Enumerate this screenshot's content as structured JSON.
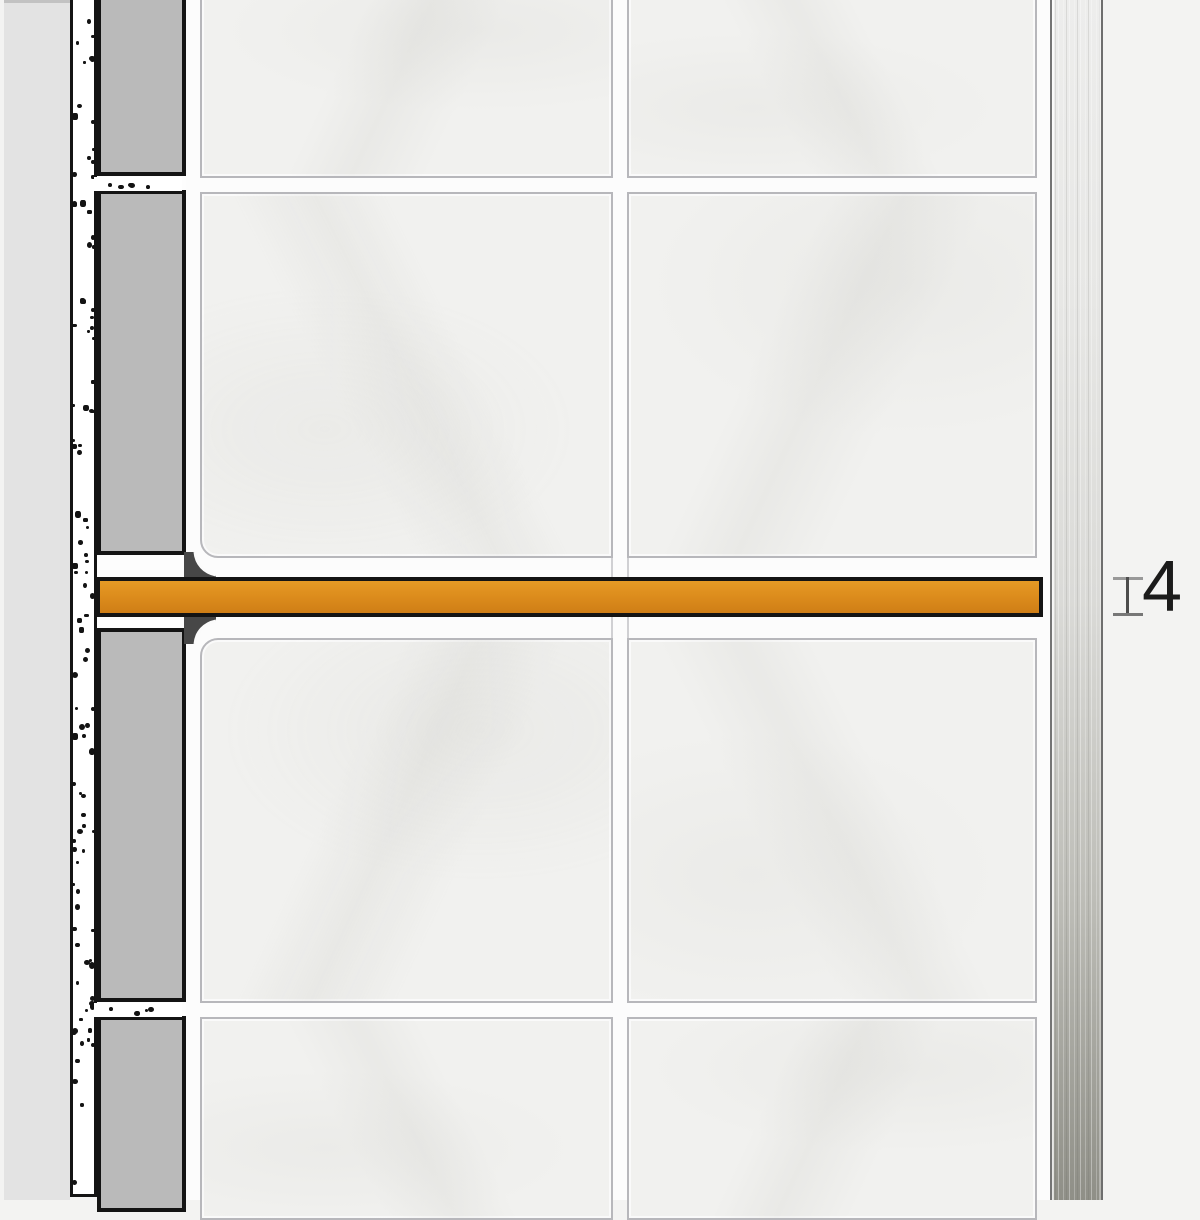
{
  "diagram": {
    "type": "tile-edge-profile-installation-cross-section",
    "dimension": {
      "value": "4"
    },
    "colors": {
      "background": "#F3F3F2",
      "substrate_gray": "#E3E3E3",
      "mortar_white": "#FFFFFF",
      "speckle_black": "#131313",
      "tile_section_gray": "#BABABA",
      "outline_black": "#141414",
      "grout_white": "#FCFCFC",
      "tile_face": "#F1F1EF",
      "tile_border": "#B7B7BB",
      "flare_dark": "#474747",
      "profile_orange_light": "#E59A25",
      "profile_orange": "#DD8D1D",
      "profile_orange_dark": "#CF7E16",
      "metal_top": "#EDEDEC",
      "metal_bottom": "#8F8F87",
      "metal_edge": "#757575",
      "dim_cap_gray": "#8F8F8F",
      "dim_stem_gray": "#4C4C4C",
      "dim_text": "#1B1B1B"
    }
  }
}
